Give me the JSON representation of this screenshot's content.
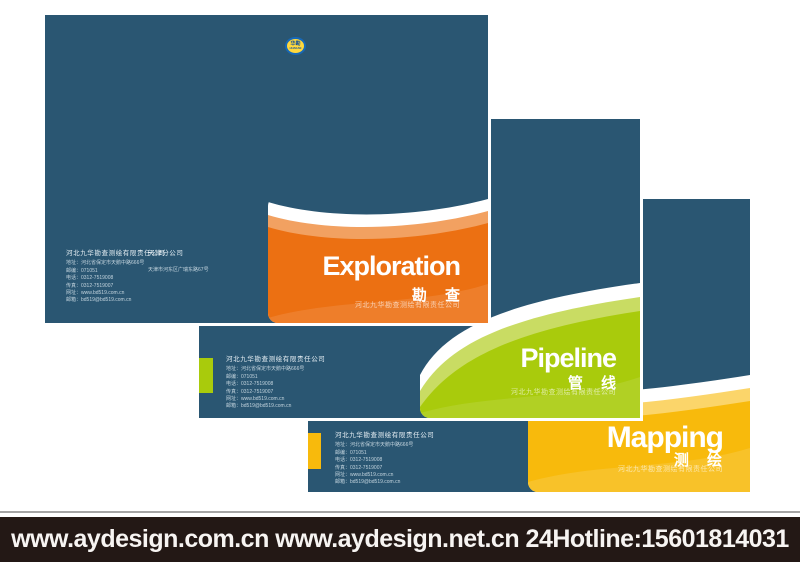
{
  "page": {
    "background_color": "#ffffff",
    "panel_blue": "#2a5672"
  },
  "logo": {
    "line1": "华勘",
    "line2": "HUAKAN",
    "ring_color": "#1668b8",
    "fill_color": "#ffd83d",
    "text_color": "#0d4f9e"
  },
  "contact": {
    "company": "河北九华勘查测绘有限责任公司",
    "lines": [
      "地址：河北省保定市天鹅中路666号",
      "邮编：071051",
      "电话：0312-7519008",
      "传真：0312-7519007",
      "网址：www.bd519.com.cn",
      "邮箱：bd519@bd519.com.cn"
    ],
    "branch_name": "天津分公司",
    "branch_address": "天津市河东区广瑞东路67号"
  },
  "panels": [
    {
      "label": "exploration-cover",
      "title_en": "Exploration",
      "title_cn": "勘 查",
      "company_sub": "河北九华勘查测绘有限责任公司",
      "panel_color": "#2a5672",
      "band_main": "#ec7012",
      "band_tint": "#f2a161"
    },
    {
      "label": "pipeline-cover",
      "title_en": "Pipeline",
      "title_cn": "管 线",
      "company_sub": "河北九华勘查测绘有限责任公司",
      "panel_color": "#2a5672",
      "band_main": "#a9cb0c",
      "band_tint": "#c9dc63"
    },
    {
      "label": "mapping-cover",
      "title_en": "Mapping",
      "title_cn": "测 绘",
      "company_sub": "河北九华勘查测绘有限责任公司",
      "panel_color": "#2a5672",
      "band_main": "#f8ba0c",
      "band_tint": "#fbd56a"
    }
  ],
  "footer": {
    "text": "www.aydesign.com.cn www.aydesign.net.cn 24Hotline:15601814031",
    "bar_color": "#231815",
    "text_color": "#f7f4f2"
  }
}
